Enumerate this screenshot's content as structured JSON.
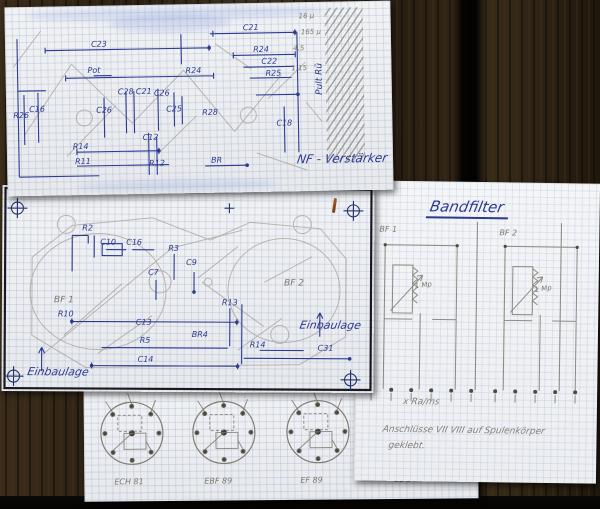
{
  "colors": {
    "ink_blue": "#2c3a92",
    "pencil": "#85817a",
    "paper": "#f1f2f4",
    "wood": "#2a2012"
  },
  "sheet1": {
    "title": "NF - Verstärker",
    "hatch_label": "Pult Rü",
    "pencil_notes": [
      "16 µ",
      "165 µ",
      "4,5",
      "1,15"
    ],
    "component_labels": [
      "C23",
      "C21",
      "R24",
      "C22",
      "R25",
      "R24",
      "Pot",
      "C28",
      "C21",
      "C26",
      "C26",
      "R26",
      "C16",
      "C25",
      "R28",
      "R14",
      "R11",
      "C12",
      "R12",
      "BR",
      "C18"
    ]
  },
  "sheet2": {
    "region_labels": [
      "BF 1",
      "BF 2"
    ],
    "component_labels": [
      "R2",
      "C10",
      "C16",
      "R3",
      "C7",
      "C9",
      "R10",
      "R13",
      "C13",
      "R5",
      "C14",
      "R14",
      "C31",
      "BR4"
    ],
    "orientation_left": "Einbaulage",
    "orientation_right": "Einbaulage"
  },
  "sheet3": {
    "title": "Bandfilter",
    "section_labels": [
      "BF 1",
      "BF 2"
    ],
    "value_labels": [
      "1 Mp",
      "1 Mp"
    ],
    "notes": [
      "x   Ra/ms",
      "Anschlüsse VII VIII auf Spulenkörper",
      "geklebt."
    ]
  },
  "sheet4": {
    "tube_labels": [
      "ECH 81",
      "EBF 89",
      "EF 89",
      "EL 84"
    ]
  }
}
